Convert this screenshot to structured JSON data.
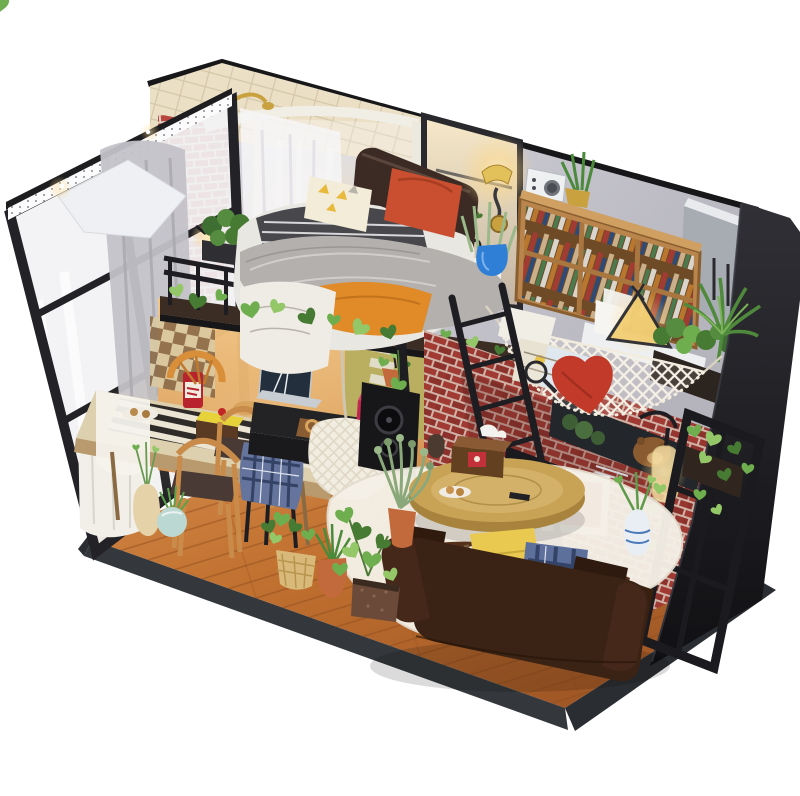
{
  "scene": {
    "type": "photograph",
    "description": "DIY miniature dollhouse kit diorama of an industrial loft apartment viewed from a front corner angle on a white background: glass-and-steel window wall with LED strip and sheer curtains on the left, corner bathroom with curved shower and mirror, loft bedroom with gray fur-covered bed, black railing draped with ivy, wall sconce, radio and wooden bookshelf, teepee lamp, white crochet hammock with red heart pillow against a red brick wall with a bear poster, speakers, ladder, dining table with cake, brown leather sofa with pillows, round coffee table on a sheepskin rug, and many potted plants along the wooden floor edge."
  },
  "palette": {
    "bg": "#ffffff",
    "metal": "#1e1e22",
    "trim": "#17171a",
    "wall": "#c9c8d1",
    "wall-light": "#dad9e0",
    "tile-cream": "#ebdfc6",
    "mortar": "#e4d6c8",
    "brick-bright": "#b8463c",
    "brick-deep": "#a03a33",
    "wood-floor": "#c0702f",
    "wood-line": "#8f4d1e",
    "rim-dark": "#34383c",
    "glass-white": "#f2f2f4",
    "curtain-gray": "#c3c2c8",
    "curtain-sheer": "#f7f6f8",
    "shower-frame": "#f1eee6",
    "headboard-brown": "#3c2b24",
    "duvet-white": "#e9e7e2",
    "fur-gray": "#b3b0ad",
    "blanket-stripe": "#47474c",
    "throw-orange": "#e08a28",
    "pillow-yellow": "#f2ecd8",
    "pillow-red": "#c94f30",
    "shelf-wood": "#b9854c",
    "wardrobe-gray": "#a7abb2",
    "hammock-white": "#f6f1e6",
    "heart-red": "#c23b2a",
    "sofa-brown": "#3a2315",
    "rug-cream": "#f5f1e8",
    "coffee-table": "#c9a355",
    "dining-table": "#ddd0ae",
    "chair-wood": "#c98b4a",
    "seat-dark": "#4a3a35",
    "bench-white": "#f1efe8",
    "desk-black": "#232326",
    "cabinet-magenta": "#c2254e",
    "knit-white": "#f2ede1",
    "plaid-blue": "#64749c",
    "leaf": "#6fae4e",
    "leaf-dark": "#477a33",
    "leaf-light": "#93c768",
    "terracotta": "#c26a3c",
    "teal-pot": "#bcd8d2",
    "blue-pot": "#2f7fd6",
    "basket-tan": "#d9b97a",
    "gold": "#c9a23f",
    "glow-warm": "#ffd98a",
    "poster-dark": "#23262a",
    "speaker-black": "#17171a",
    "frame-red-interior": "#d8344e",
    "panel-black": "#26262b",
    "radio-white": "#eef0f2",
    "sage-green": "#9ab88a",
    "cream-vase": "#e6d2a8",
    "checker-light": "#d9c9a2",
    "checker-dark": "#8a6a48",
    "olive-wall": "#b5ae5e"
  },
  "objects": {
    "left_wall": [
      "black steel window wall with glass panes",
      "LED light strip along top rail",
      "gray drape curtain",
      "white sheer curtain",
      "small lit wall lamp"
    ],
    "bathroom": [
      "cream tiled wall",
      "red brick panel",
      "curved white shower enclosure",
      "gold shower head",
      "black framed mirror",
      "white vanity sink"
    ],
    "loft_bedroom": [
      "dark padded headboard",
      "yellow triangle-print pillow",
      "red-orange pillow",
      "striped blanket",
      "gray fur throw",
      "white leaf-print duvet",
      "orange throw",
      "black railing with ivy garland",
      "railing planter box"
    ],
    "wall_decor": [
      "lit gold wall sconce",
      "white radio",
      "plant in gold pot",
      "sage plant in blue vase"
    ],
    "right_upper": [
      "wooden bookshelf full of books",
      "teepee lamp",
      "gray wardrobe cabinet",
      "palm plant",
      "black exterior panel"
    ],
    "hammock_corner": [
      "white crochet hammock",
      "red heart pillow",
      "map papers",
      "magnifying glass",
      "bear poster",
      "red brick wall",
      "hanging glass bottle with ivy",
      "planter boxes",
      "black lattice window frame",
      "two black speakers",
      "white shadow box with red room",
      "letter-block art",
      "black ladder"
    ],
    "dining_area": [
      "checkerboard wallpaper patch",
      "long wooden table with striped runner",
      "chocolate cake with yellow icing",
      "teal cup",
      "red jar",
      "bread",
      "wicker chair",
      "two wooden chairs",
      "white bench",
      "stool with blue plaid blanket",
      "laptop on black desk",
      "tray of pretzels",
      "magenta cabinet",
      "white knit hanging chair",
      "hanging ivy pot"
    ],
    "living_room": [
      "white sheepskin rug",
      "round wooden coffee table",
      "tissue box",
      "cookie plate",
      "remote",
      "brown leather sofa",
      "striped pillow",
      "yellow pillow",
      "blue plaid pillow",
      "dark brown pillows"
    ],
    "floor": [
      "orange-brown plank floor",
      "dark gray base rim",
      "teal ball pot",
      "cream vase with sprigs",
      "woven basket plant",
      "terracotta urn with spiky plant",
      "cube planter with ivy",
      "sage in terracotta pot",
      "blue striped vase"
    ]
  }
}
